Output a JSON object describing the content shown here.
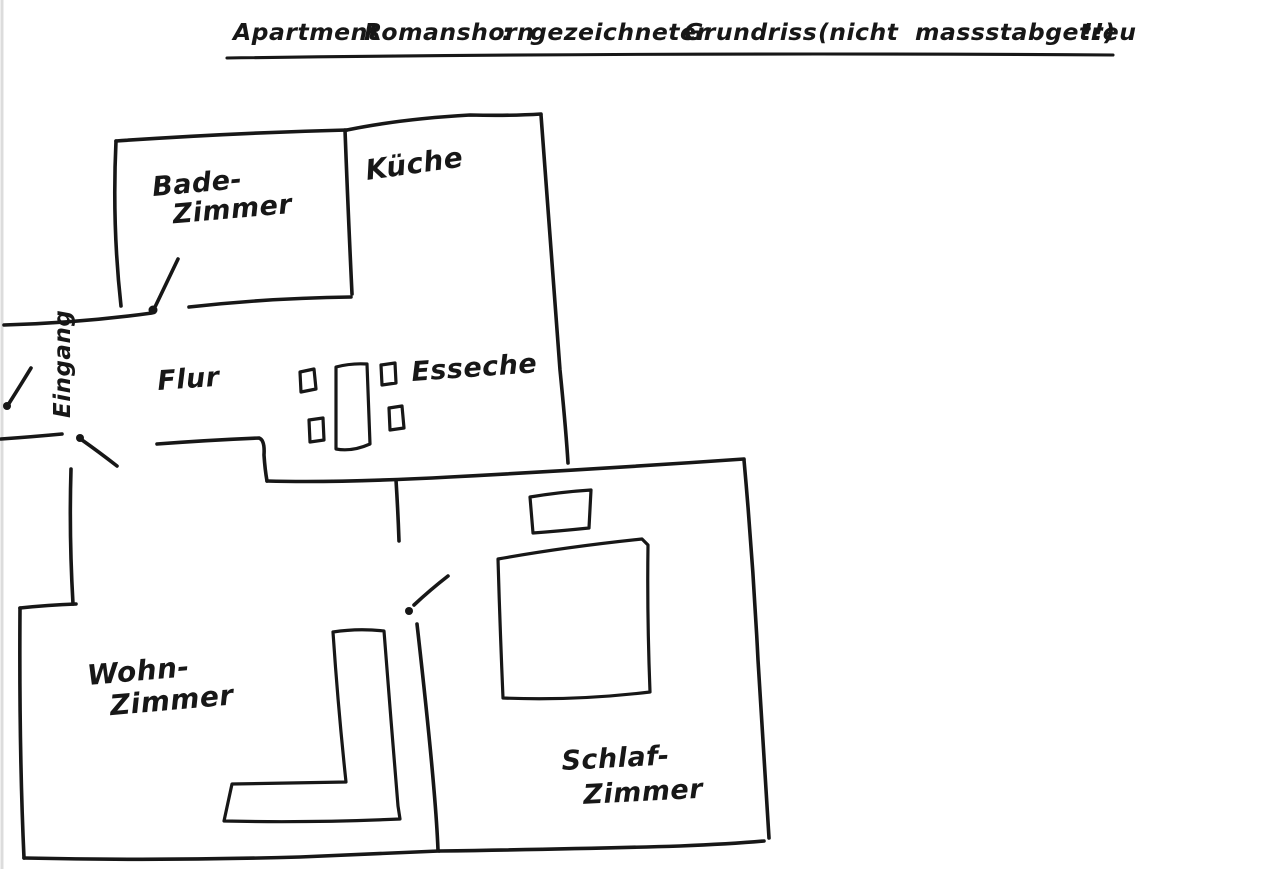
{
  "colors": {
    "ink": "#171717",
    "background": "#ffffff",
    "canvas_edge": "#dcdcdc"
  },
  "title": {
    "words": [
      "Apartment",
      "Romanshorn",
      ":",
      "gezeichneter",
      "Grundriss",
      "(nicht",
      "massstabgetreu",
      "!!)"
    ]
  },
  "rooms": {
    "badezimmer": {
      "line1": "Bade-",
      "line2": "Zimmer"
    },
    "kueche": {
      "label": "Küche"
    },
    "flur": {
      "label": "Flur"
    },
    "eingang": {
      "label": "Eingang"
    },
    "essecke": {
      "label": "Esseche"
    },
    "wohnzimmer": {
      "line1": "Wohn-",
      "line2": "Zimmer"
    },
    "schlafzimmer": {
      "line1": "Schlaf-",
      "line2": "Zimmer"
    }
  },
  "furniture": {
    "dining_table": "dining-table",
    "dining_chair_count": 4,
    "bed": "double-bed",
    "bedside_table": "small-rectangle-table",
    "sofa": "l-shaped-corner-sofa"
  },
  "doors": {
    "count": 4,
    "locations": [
      "Eingang",
      "Badezimmer",
      "Wohnzimmer",
      "Schlafzimmer"
    ]
  }
}
